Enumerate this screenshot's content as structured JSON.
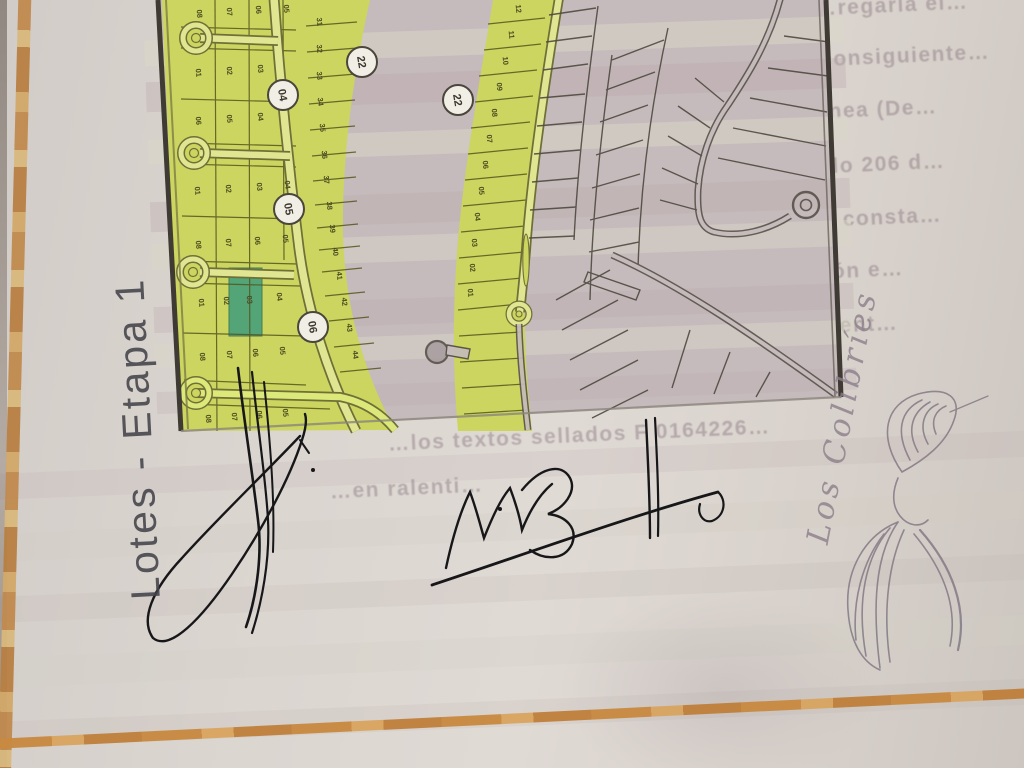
{
  "document": {
    "vertical_title": "Lotes - Etapa 1",
    "brand_script": "Los Colibríes"
  },
  "colors": {
    "lot_green": "#cbd55f",
    "road_green": "#e0e592",
    "highlight_teal": "#3f9c7c",
    "paper": "#dcd6d1",
    "map_base_pink": "#c8bdbe",
    "frame_orange": "#c8893f",
    "ink": "#17171a",
    "pencil_gray": "#837a85"
  },
  "map": {
    "highlighted_lot": {
      "label": "03",
      "color": "#3f9c7c"
    },
    "badges": [
      {
        "label": "04",
        "x": 283,
        "y": 95
      },
      {
        "label": "05",
        "x": 289,
        "y": 209
      },
      {
        "label": "06",
        "x": 313,
        "y": 327
      },
      {
        "label": "22",
        "x": 362,
        "y": 62
      },
      {
        "label": "22",
        "x": 458,
        "y": 100
      }
    ],
    "lot_labels": [
      {
        "t": "08",
        "x": 197,
        "y": 14
      },
      {
        "t": "07",
        "x": 227,
        "y": 12
      },
      {
        "t": "06",
        "x": 256,
        "y": 10
      },
      {
        "t": "05",
        "x": 284,
        "y": 9
      },
      {
        "t": "01",
        "x": 196,
        "y": 73
      },
      {
        "t": "02",
        "x": 227,
        "y": 71
      },
      {
        "t": "03",
        "x": 258,
        "y": 69
      },
      {
        "t": "06",
        "x": 196,
        "y": 121
      },
      {
        "t": "05",
        "x": 227,
        "y": 119
      },
      {
        "t": "04",
        "x": 258,
        "y": 117
      },
      {
        "t": "01",
        "x": 195,
        "y": 191
      },
      {
        "t": "02",
        "x": 226,
        "y": 189
      },
      {
        "t": "03",
        "x": 257,
        "y": 187
      },
      {
        "t": "04",
        "x": 285,
        "y": 185
      },
      {
        "t": "08",
        "x": 196,
        "y": 245
      },
      {
        "t": "07",
        "x": 226,
        "y": 243
      },
      {
        "t": "06",
        "x": 255,
        "y": 241
      },
      {
        "t": "05",
        "x": 283,
        "y": 239
      },
      {
        "t": "01",
        "x": 199,
        "y": 303
      },
      {
        "t": "02",
        "x": 224,
        "y": 301
      },
      {
        "t": "03",
        "x": 247,
        "y": 300
      },
      {
        "t": "04",
        "x": 277,
        "y": 297
      },
      {
        "t": "08",
        "x": 200,
        "y": 357
      },
      {
        "t": "07",
        "x": 227,
        "y": 355
      },
      {
        "t": "06",
        "x": 253,
        "y": 353
      },
      {
        "t": "05",
        "x": 280,
        "y": 351
      },
      {
        "t": "08",
        "x": 206,
        "y": 419
      },
      {
        "t": "07",
        "x": 232,
        "y": 417
      },
      {
        "t": "06",
        "x": 257,
        "y": 415
      },
      {
        "t": "05",
        "x": 283,
        "y": 413
      },
      {
        "t": "31",
        "x": 317,
        "y": 22
      },
      {
        "t": "32",
        "x": 317,
        "y": 49
      },
      {
        "t": "33",
        "x": 317,
        "y": 76
      },
      {
        "t": "34",
        "x": 318,
        "y": 102
      },
      {
        "t": "35",
        "x": 320,
        "y": 128
      },
      {
        "t": "36",
        "x": 322,
        "y": 155
      },
      {
        "t": "37",
        "x": 324,
        "y": 180
      },
      {
        "t": "38",
        "x": 327,
        "y": 206
      },
      {
        "t": "39",
        "x": 330,
        "y": 229
      },
      {
        "t": "40",
        "x": 333,
        "y": 252
      },
      {
        "t": "41",
        "x": 337,
        "y": 276
      },
      {
        "t": "42",
        "x": 342,
        "y": 302
      },
      {
        "t": "43",
        "x": 347,
        "y": 328
      },
      {
        "t": "44",
        "x": 353,
        "y": 355
      },
      {
        "t": "12",
        "x": 516,
        "y": 9
      },
      {
        "t": "11",
        "x": 509,
        "y": 35
      },
      {
        "t": "10",
        "x": 503,
        "y": 61
      },
      {
        "t": "09",
        "x": 497,
        "y": 87
      },
      {
        "t": "08",
        "x": 492,
        "y": 113
      },
      {
        "t": "07",
        "x": 487,
        "y": 139
      },
      {
        "t": "06",
        "x": 483,
        "y": 165
      },
      {
        "t": "05",
        "x": 479,
        "y": 191
      },
      {
        "t": "04",
        "x": 475,
        "y": 217
      },
      {
        "t": "03",
        "x": 472,
        "y": 243
      },
      {
        "t": "02",
        "x": 470,
        "y": 268
      },
      {
        "t": "01",
        "x": 468,
        "y": 293
      }
    ]
  },
  "faint_text_lines": [
    {
      "text": "…regarla el…",
      "x": 815,
      "y": -6
    },
    {
      "text": "…por consiguiente…",
      "x": 752,
      "y": 46
    },
    {
      "text": "…rio winnea (De…",
      "x": 728,
      "y": 100
    },
    {
      "text": "…al artículo 206 d…",
      "x": 716,
      "y": 155
    },
    {
      "text": "…dificación consta…",
      "x": 700,
      "y": 209
    },
    {
      "text": "…participación e…",
      "x": 688,
      "y": 262
    },
    {
      "text": "…ita de los lument…",
      "x": 662,
      "y": 317
    },
    {
      "text": "…constancia s…",
      "x": 652,
      "y": 371
    },
    {
      "text": "…los textos sellados F 0164226…",
      "x": 388,
      "y": 424
    },
    {
      "text": "…en ralenti…",
      "x": 330,
      "y": 477
    }
  ]
}
